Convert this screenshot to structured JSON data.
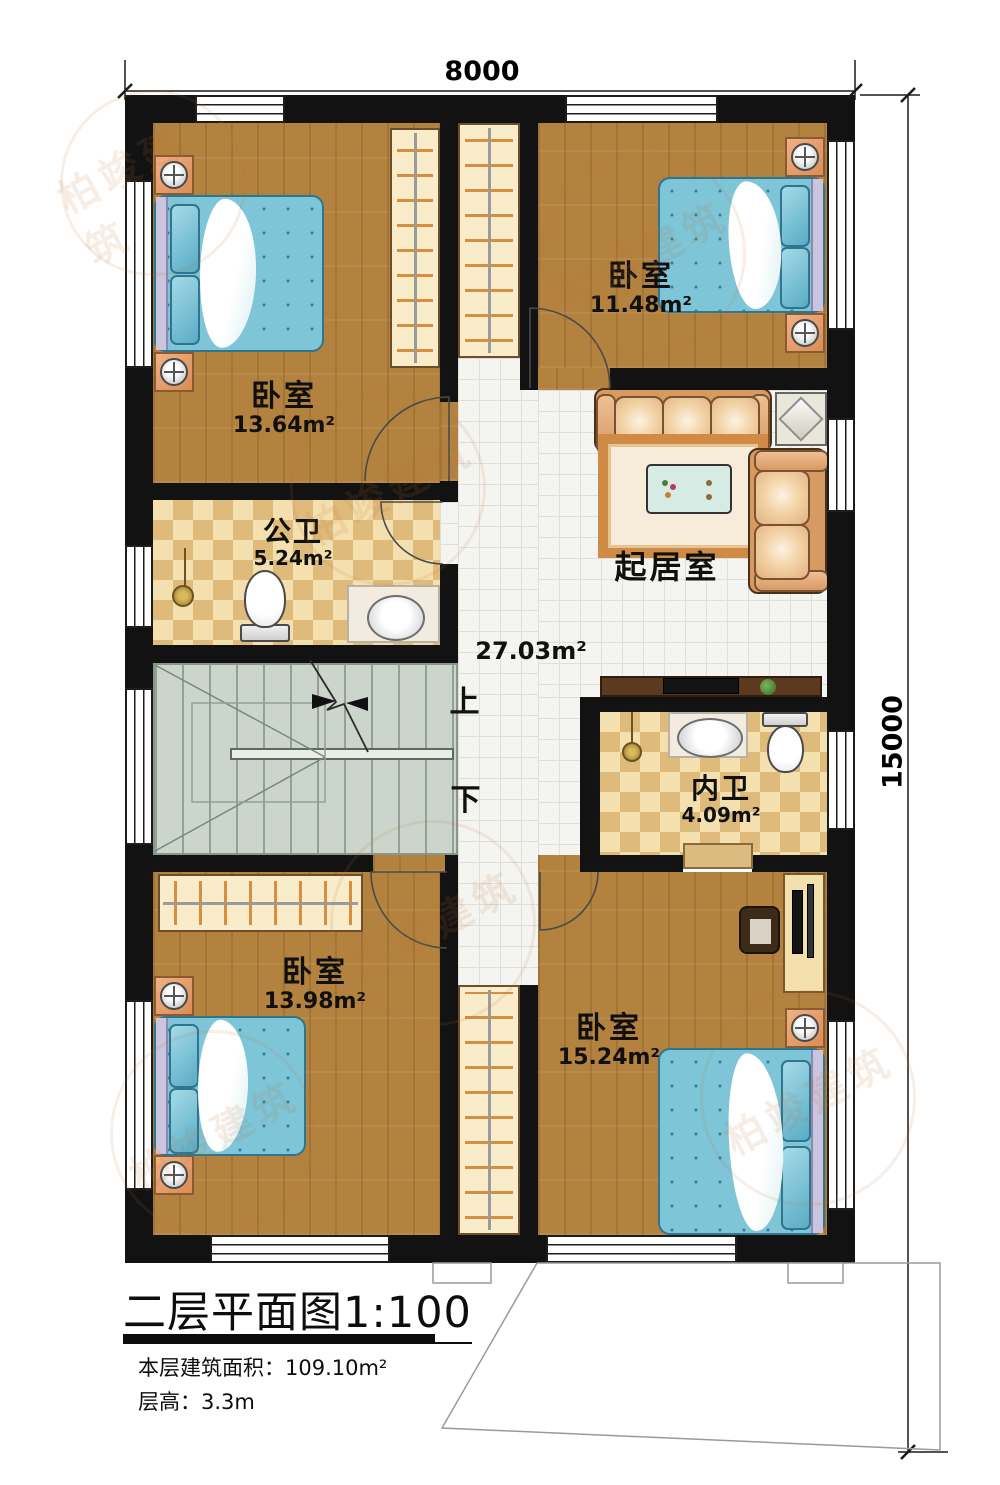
{
  "plan": {
    "dimensions": {
      "width_label": "8000",
      "height_label": "15000"
    },
    "rooms": {
      "bedroom_top_left": {
        "name": "卧室",
        "area": "13.64m²"
      },
      "bedroom_top_right": {
        "name": "卧室",
        "area": "11.48m²"
      },
      "public_bath": {
        "name": "公卫",
        "area": "5.24m²"
      },
      "living": {
        "name": "起居室",
        "area": "27.03m²"
      },
      "inner_bath": {
        "name": "内卫",
        "area": "4.09m²"
      },
      "bedroom_bottom_left": {
        "name": "卧室",
        "area": "13.98m²"
      },
      "bedroom_bottom_right": {
        "name": "卧室",
        "area": "15.24m²"
      }
    },
    "stairs": {
      "up_label": "上",
      "down_label": "下"
    },
    "title_block": {
      "title": "二层平面图1:100",
      "area_line": "本层建筑面积：109.10m²",
      "floor_height_line": "层高：3.3m"
    },
    "watermark_text": "柏竣建筑",
    "colors": {
      "wall": "#121212",
      "wood_floor": "#b2823e",
      "bed_blue": "#7ec5d8",
      "tile_light": "#f4dfae",
      "tile_dark": "#debb7b",
      "stair_gray": "#cbd5cb",
      "furniture_orange": "#d98c55",
      "sofa_tan": "#d89a63"
    }
  }
}
